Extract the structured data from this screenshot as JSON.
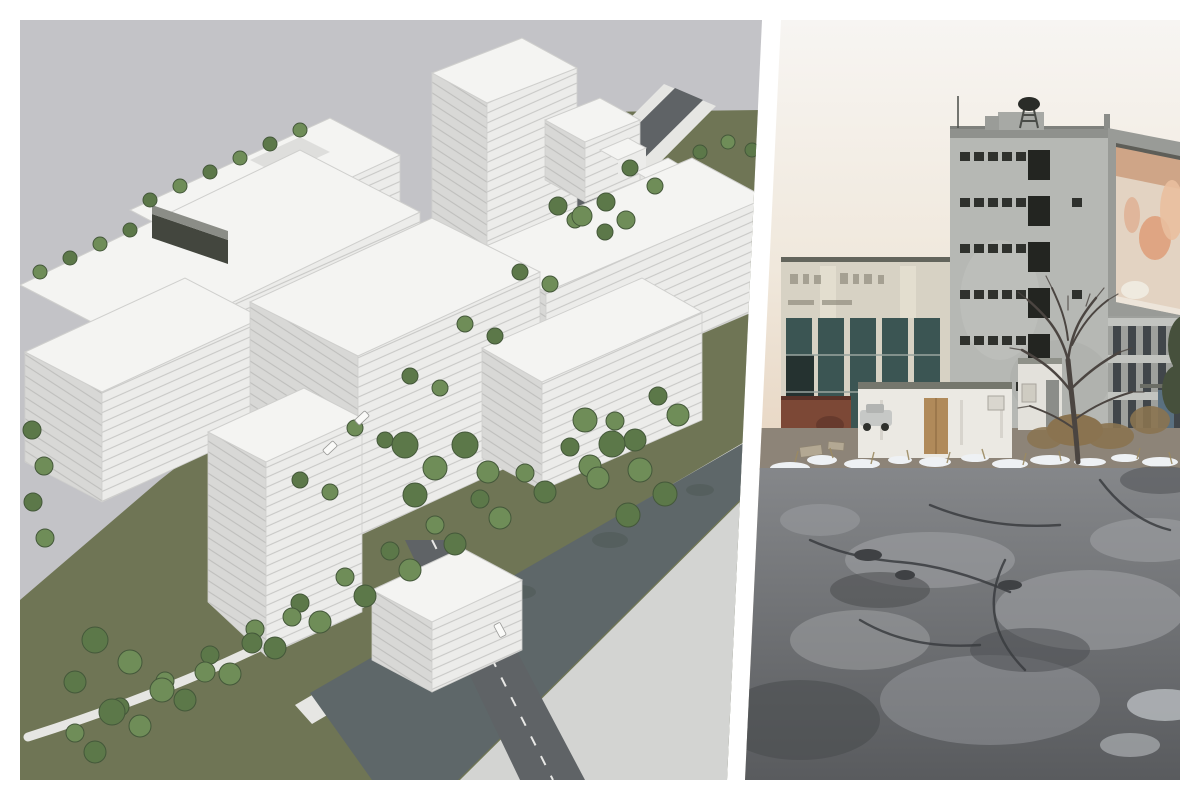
{
  "page": {
    "background": "#ffffff",
    "kind": "diptych-collage",
    "description": "Two images side by side separated by a diagonal white divider: an aerial 3D masterplan rendering on the left and a photograph of the existing derelict industrial site on the right."
  },
  "left_panel": {
    "description": "Aerial 3D rendering of a planned district: white modernist slab buildings with striped facades, rooftop and courtyard trees, a diagonal tree-lined avenue, a green field, a canal with promenade and a road bridge, under a flat gray sky.",
    "elements": [
      "gray sky",
      "olive green ground",
      "white slab buildings",
      "dark parking structure",
      "tree-lined avenue with cars",
      "courtyard trees",
      "canal water",
      "promenade with double tree row",
      "road bridge with dashed centerline",
      "light gray embankment"
    ]
  },
  "right_panel": {
    "description": "Winter photograph of the existing site: a derelict gray concrete tower with empty window openings and a rooftop siren, a faded orange billboard on its side, an old industrial hall with dark glazing, a white shed with boarded door, a bare tree, patches of snow and a large cracked asphalt lot.",
    "elements": [
      "pale warm sky",
      "industrial hall with teal glazing",
      "rusty red wall",
      "concrete tower",
      "rooftop siren",
      "faded orange billboard",
      "office wing with window grid",
      "white shed with plywood door",
      "parked car",
      "kiosk",
      "bare tree",
      "evergreen tree",
      "dry shrubs",
      "snow patches",
      "cracked asphalt lot"
    ]
  },
  "divider": {
    "color": "#ffffff",
    "orientation": "diagonal, leaning left toward the bottom"
  },
  "palette": {
    "page-bg": "#ffffff",
    "l-sky": "#c3c3c7",
    "l-grass": "#6f7555",
    "l-walk": "#e6e6e3",
    "l-road": "#5f6366",
    "l-water": "#5e6769",
    "l-refl": "#4f5a56",
    "l-bank": "#d3d4d2",
    "l-roof": "#f4f4f2",
    "l-faceA": "#d8d8d6",
    "l-faceB": "#ececea",
    "l-stripe": "#c9c9c7",
    "l-stripeA": "#bfbfbd",
    "l-edge": "#cfcfcd",
    "l-tree1": "#5c7849",
    "l-tree2": "#6f8d58",
    "l-treedk": "#44583a",
    "l-dark": "#43463e",
    "l-car": "#fafaf8",
    "r-sky-top": "#f7f5f2",
    "r-sky-mid": "#f0e8dc",
    "r-horizon": "#e9d9c7",
    "r-tower": "#b6b8b4",
    "r-tower-side": "#999b97",
    "r-parapet": "#8f918d",
    "r-pent": "#a7a9a5",
    "r-win": "#2f312d",
    "r-open": "#232521",
    "r-bill-base": "#e3d3c2",
    "r-bill-orange": "#dd9a73",
    "r-bill-hi": "#e9bf9f",
    "r-bill-streak": "#bf8058",
    "r-wing": "#9ea09c",
    "r-wing-band": "#c2c4c0",
    "r-wing-win": "#41464a",
    "r-hall": "#d7d2c4",
    "r-hall-hi": "#e3decf",
    "r-coping": "#63655c",
    "r-glass": "#3b5553",
    "r-glass-dk": "#253230",
    "r-tan": "#ccc1a5",
    "r-mark": "#8b8678",
    "r-rust": "#7c4836",
    "r-rust-dk": "#5a3228",
    "r-shed": "#ebe9e3",
    "r-shed-roof": "#75776d",
    "r-ply": "#b08a5a",
    "r-dirt": "#8d8478",
    "r-snow": "#eef1f4",
    "r-asph-hi": "#85878a",
    "r-asph-lo": "#595b5e",
    "r-patch": "#9ea0a3",
    "r-blotch": "#4a4c4f",
    "r-crack": "#3a3c3f",
    "r-branch": "#4b4541",
    "r-conifer": "#46503c",
    "r-conifer-dk": "#37422f",
    "r-shrub": "#8a7350",
    "r-tuft": "#9a8a62",
    "r-blue-door": "#5a7080",
    "r-kiosk": "#e3e1db"
  }
}
